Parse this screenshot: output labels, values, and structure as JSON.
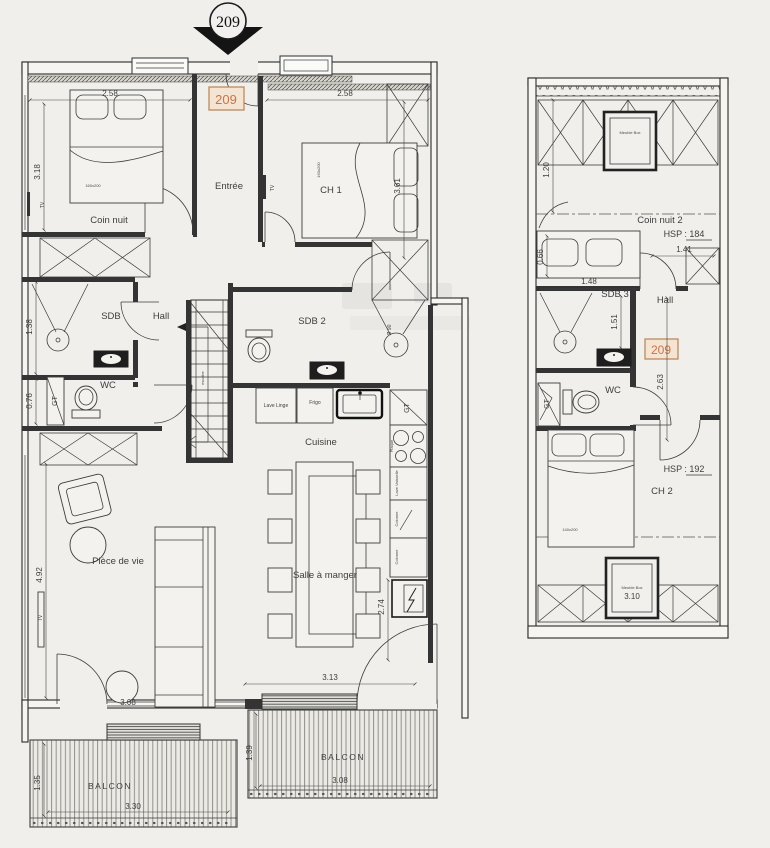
{
  "marker_number": "209",
  "badge_number": "209",
  "colors": {
    "badge_border": "#b98a63",
    "badge_fill": "#f5e4d2",
    "badge_text": "#c4764d"
  },
  "l1": {
    "rooms": {
      "coin_nuit": "Coin nuit",
      "entree": "Entrée",
      "ch1": "CH 1",
      "sdb": "SDB",
      "hall": "Hall",
      "wc": "WC",
      "sdb2": "SDB 2",
      "cuisine": "Cuisine",
      "piece_de_vie": "Pièce de vie",
      "salle_a_manger": "Salle à manger",
      "balcon_left": "BALCON",
      "balcon_right": "BALCON"
    },
    "furniture": {
      "bed_coin_nuit": "160x200",
      "bed_ch1": "160x200",
      "tv_coin_nuit": "TV",
      "tv_ch1": "TV",
      "tv_sejour": "TV",
      "gt_wc": "GT",
      "gt_cuisine": "GT",
      "shower_diameter": "Ø 90",
      "lave_linge": "Lave Linge",
      "frigo": "Frigo",
      "plaque": "Plaque",
      "lave_vaisselle": "Lave Vaisselle",
      "colonne_1": "Colonne",
      "colonne_2": "Colonne",
      "stairs_note": "escalier"
    },
    "dims": {
      "coin_nuit_w": "2.58",
      "coin_nuit_h": "3.18",
      "ch1_w": "2.58",
      "ch1_h": "3.61",
      "sdb_h": "1.38",
      "wc_h": "0.76",
      "sejour_h": "4.92",
      "sejour_w": "3.08",
      "dining_w": "3.13",
      "kitchen_h": "2.74",
      "balcon_l_d": "1.35",
      "balcon_l_w": "3.30",
      "balcon_r_d": "1.39",
      "balcon_r_w": "3.08"
    }
  },
  "l2": {
    "rooms": {
      "coin_nuit2": "Coin nuit 2",
      "sdb3": "SDB 3",
      "hall": "Hall",
      "wc": "WC",
      "ch2": "CH 2"
    },
    "notes": {
      "hsp_coin_nuit": "HSP : 184",
      "hsp_ch2": "HSP : 192",
      "meuble_box_top": "Meuble Box",
      "meuble_box_bottom": "Meuble Box"
    },
    "furniture": {
      "bed_ch2": "140x200",
      "gt": "GT"
    },
    "dims": {
      "h120": "1.20",
      "w141": "1.41",
      "h066": "0.66",
      "w148": "1.48",
      "h151": "1.51",
      "h263": "2.63",
      "w310": "3.10"
    }
  }
}
